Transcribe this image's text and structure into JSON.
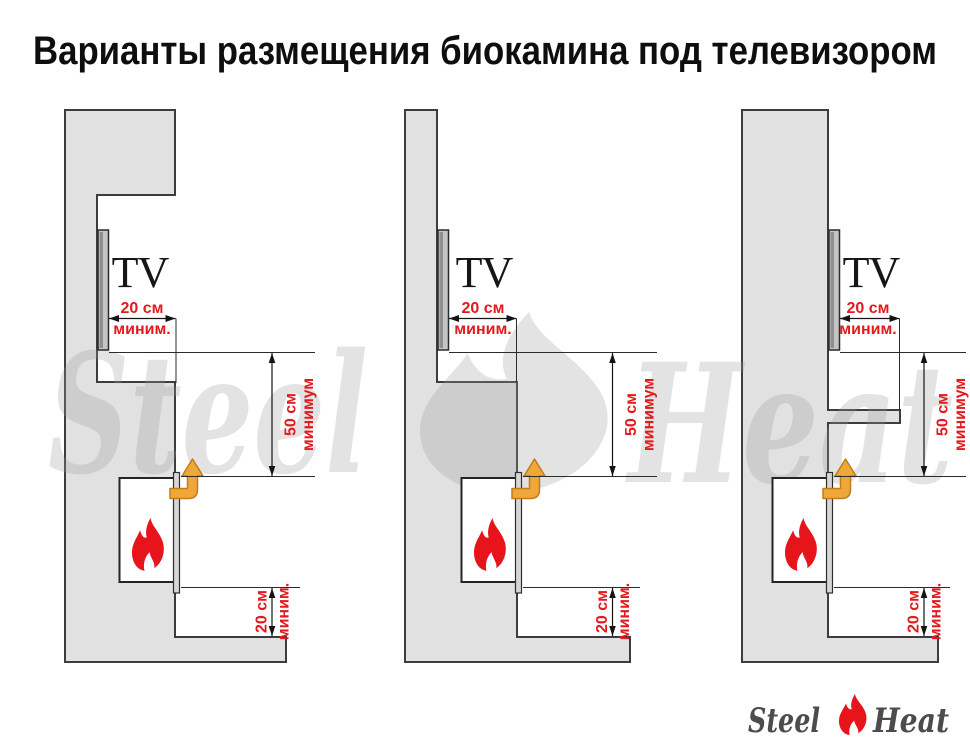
{
  "title": "Варианты размещения биокамина под телевизором",
  "brand": {
    "watermark_left": "Steel",
    "watermark_right": "Heat",
    "logo_left": "Steel",
    "logo_right": "Heat"
  },
  "colors": {
    "dimension_red": "#e3191e",
    "arrow_orange": "#f0a73a",
    "flame_red": "#e8141c",
    "wall_gray": "#e1e1e1"
  },
  "variants": [
    {
      "id": 1,
      "tv_label": "TV",
      "dims": {
        "tv_side": {
          "value": "20 см",
          "qualifier": "миним."
        },
        "tv_to_fireplace": {
          "value": "50 см",
          "qualifier": "минимум"
        },
        "fireplace_to_base": {
          "value": "20 см",
          "qualifier": "миним."
        }
      }
    },
    {
      "id": 2,
      "tv_label": "TV",
      "dims": {
        "tv_side": {
          "value": "20 см",
          "qualifier": "миним."
        },
        "tv_to_fireplace": {
          "value": "50 см",
          "qualifier": "минимум"
        },
        "fireplace_to_base": {
          "value": "20 см",
          "qualifier": "миним."
        }
      }
    },
    {
      "id": 3,
      "tv_label": "TV",
      "dims": {
        "tv_side": {
          "value": "20 см",
          "qualifier": "миним."
        },
        "tv_to_fireplace": {
          "value": "50 см",
          "qualifier": "минимум"
        },
        "fireplace_to_base": {
          "value": "20 см",
          "qualifier": "миним."
        }
      }
    }
  ]
}
